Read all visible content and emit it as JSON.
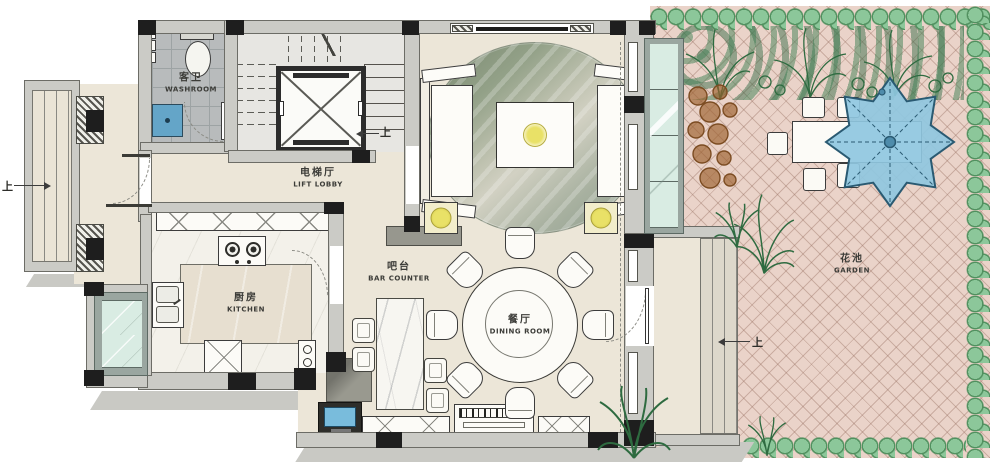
{
  "plan": {
    "title": "Residential first-floor plan with garden",
    "rooms": {
      "washroom": {
        "cn": "客卫",
        "en": "WASHROOM"
      },
      "lift_lobby": {
        "cn": "电梯厅",
        "en": "LIFT LOBBY"
      },
      "kitchen": {
        "cn": "厨房",
        "en": "KITCHEN"
      },
      "bar_counter": {
        "cn": "吧台",
        "en": "BAR COUNTER"
      },
      "dining_room": {
        "cn": "餐厅",
        "en": "DINING ROOM"
      },
      "garden": {
        "cn": "花池",
        "en": "GARDEN"
      }
    },
    "direction_labels": {
      "entry_up": "上",
      "stair_up": "上",
      "garden_up": "上"
    },
    "icons": {
      "elevator": "elevator-shaft-x",
      "stairs": "stair-treads",
      "toilet": "toilet",
      "basin": "blue-basin",
      "stove": "two-burner-stove",
      "sofa": "sofa-pair",
      "coffee_table": "coffee-table-with-light",
      "dining_table": "round-table-8-chairs",
      "bar": "marble-bar-counter",
      "tv": "tv-screen",
      "sideboard": "sideboard",
      "parasol": "blue-parasol",
      "outdoor_table": "garden-table-5-chairs"
    }
  },
  "colors": {
    "floor": "#ece6d8",
    "wall": "#cbcbc6",
    "ink": "#1e1e1e",
    "tile": "#b8bbbc",
    "paving": "#ead3c9",
    "bush": "#8cc79a",
    "bush_edge": "#51905f",
    "foliage": "#2e6b40",
    "brown": "#7c4c22",
    "parasol": "#8fc7e0",
    "parasol_edge": "#2a5a72",
    "glass": "#d9ece3",
    "frame": "#9aa6a0",
    "sink": "#64a5c8",
    "tv": "#79bcdc",
    "lamp": "#e9e167",
    "label": "#3c3c38",
    "shadow": "#c9c9c4",
    "marble": "#f7f6f1",
    "island": "#e7dfd0"
  }
}
